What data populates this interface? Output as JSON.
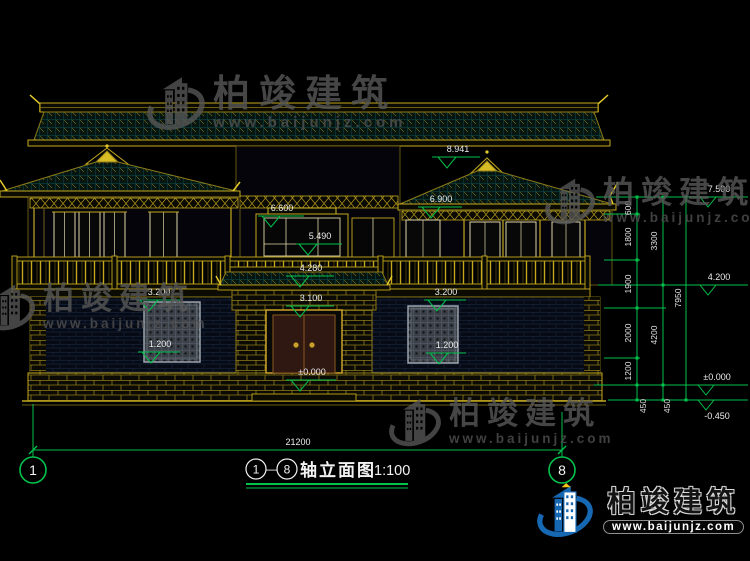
{
  "watermark": {
    "brand": "柏竣建筑",
    "url": "www.baijunjz.com"
  },
  "title": {
    "axis_start": "1",
    "axis_end": "8",
    "separator": "—",
    "name": "轴立面图",
    "scale": "1:100"
  },
  "axes": {
    "left": "1",
    "right": "8"
  },
  "dims": {
    "total_width": "21200",
    "chain_inner": [
      "600",
      "1800",
      "1900",
      "2000",
      "1200",
      "450"
    ],
    "chain_mid": [
      "3300",
      "4200",
      "450"
    ],
    "chain_outer": "7950",
    "levels_right": {
      "top": "7.500",
      "mid": "4.200",
      "zero": "±0.000",
      "ground": "-0.450"
    },
    "marks": {
      "ridge": "8.941",
      "right_eave": "6.900",
      "center_top": "6.600",
      "center_mid": "5.490",
      "gate_roof": "4.280",
      "door_top": "3.100",
      "left_window_top": "3.200",
      "left_window_sill": "1.200",
      "right_window_top": "3.200",
      "right_window_sill": "1.200",
      "entry_zero": "±0.000"
    }
  }
}
